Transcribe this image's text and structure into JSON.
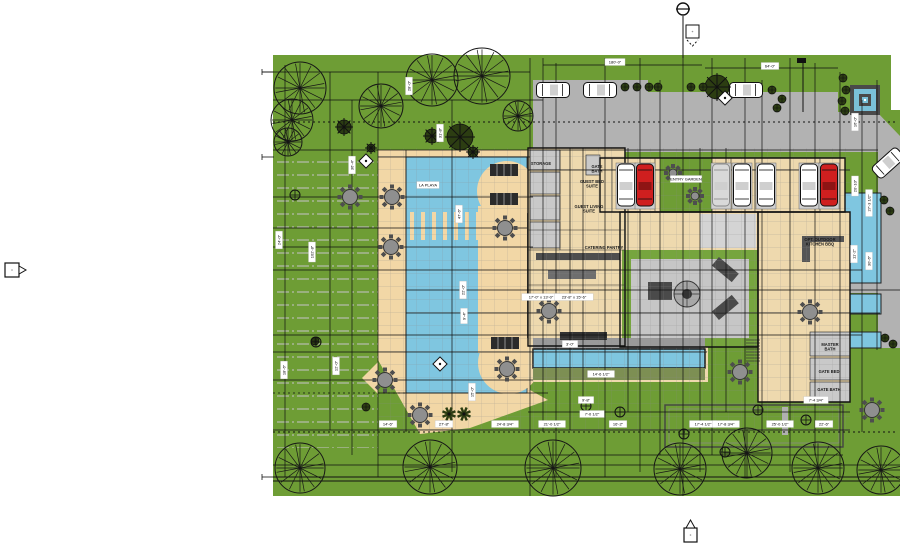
{
  "meta": {
    "drawing_type": "architectural site plan",
    "pool_label": "LA PLAYA"
  },
  "colors": {
    "lawn": "#6e9d35",
    "lawn_stripe": "#a9b698",
    "deck": "#f2d7a6",
    "pool": "#7fc6e0",
    "drive": "#b2b2b2",
    "floor": "#eed9ae",
    "room_gray": "#c9c9c9",
    "court_gray": "#c6c6c6",
    "court_green": "#76a53e",
    "planter_olive": "#7d8f53",
    "dark_furniture": "#3c3c3c",
    "car_red": "#cf1f1f",
    "car_white": "#ffffff",
    "car_ghost": "#d9d9d9",
    "fountain_frame": "#4a4a4a",
    "tree_dark": "#2c3d12"
  },
  "grid": {
    "verticals": [
      [
        285,
        65,
        477
      ],
      [
        330,
        72,
        430
      ],
      [
        352,
        100,
        455
      ],
      [
        378,
        72,
        477
      ],
      [
        406,
        150,
        432
      ],
      [
        452,
        100,
        472
      ],
      [
        530,
        58,
        496
      ],
      [
        543,
        58,
        432
      ],
      [
        556,
        63,
        477
      ],
      [
        570,
        148,
        430
      ],
      [
        583,
        148,
        402
      ],
      [
        605,
        58,
        477
      ],
      [
        628,
        148,
        412
      ],
      [
        640,
        58,
        472
      ],
      [
        660,
        80,
        455
      ],
      [
        683,
        16,
        496
      ],
      [
        700,
        148,
        472
      ],
      [
        712,
        58,
        455
      ],
      [
        726,
        148,
        412
      ],
      [
        745,
        58,
        477
      ],
      [
        762,
        80,
        432
      ],
      [
        790,
        58,
        472
      ],
      [
        815,
        63,
        455
      ],
      [
        840,
        72,
        477
      ],
      [
        862,
        100,
        432
      ],
      [
        877,
        80,
        350
      ]
    ],
    "horizontals": [
      [
        72,
        262,
        530
      ],
      [
        100,
        273,
        543
      ],
      [
        150,
        273,
        878
      ],
      [
        157,
        378,
        530
      ],
      [
        170,
        528,
        850
      ],
      [
        197,
        273,
        533
      ],
      [
        212,
        600,
        850
      ],
      [
        228,
        273,
        527
      ],
      [
        247,
        273,
        533
      ],
      [
        270,
        273,
        862
      ],
      [
        290,
        406,
        900
      ],
      [
        313,
        406,
        880
      ],
      [
        335,
        273,
        862
      ],
      [
        352,
        273,
        707
      ],
      [
        380,
        273,
        533
      ],
      [
        393,
        378,
        548
      ],
      [
        412,
        528,
        850
      ],
      [
        430,
        273,
        850
      ],
      [
        455,
        378,
        843
      ],
      [
        465,
        273,
        900
      ],
      [
        65,
        543,
        702
      ],
      [
        68,
        705,
        838
      ]
    ]
  },
  "dimensions": [
    {
      "x": 279,
      "y": 240,
      "rot": -90,
      "text": "24'-0\""
    },
    {
      "x": 284,
      "y": 370,
      "rot": -90,
      "text": "18'-6\""
    },
    {
      "x": 312,
      "y": 252,
      "rot": -90,
      "text": "102'-8\""
    },
    {
      "x": 336,
      "y": 366,
      "rot": -90,
      "text": "12'-0\""
    },
    {
      "x": 352,
      "y": 165,
      "rot": -90,
      "text": "36'-4\""
    },
    {
      "x": 409,
      "y": 86,
      "rot": -90,
      "text": "28'-0\""
    },
    {
      "x": 440,
      "y": 133,
      "rot": -90,
      "text": "31'-8\""
    },
    {
      "x": 459,
      "y": 214,
      "rot": -90,
      "text": "47'-6\""
    },
    {
      "x": 463,
      "y": 290,
      "rot": -90,
      "text": "22'-0\""
    },
    {
      "x": 464,
      "y": 316,
      "rot": -90,
      "text": "9'-4\""
    },
    {
      "x": 472,
      "y": 392,
      "rot": -90,
      "text": "15'-0\""
    },
    {
      "x": 615,
      "y": 62,
      "rot": 0,
      "text": "180'-0\""
    },
    {
      "x": 770,
      "y": 66,
      "rot": 0,
      "text": "64'-0\""
    },
    {
      "x": 855,
      "y": 122,
      "rot": -90,
      "text": "16'-0\""
    },
    {
      "x": 855,
      "y": 186,
      "rot": -90,
      "text": "20'-10\""
    },
    {
      "x": 869,
      "y": 203,
      "rot": -90,
      "text": "27'-3 1/2\""
    },
    {
      "x": 854,
      "y": 254,
      "rot": -90,
      "text": "11'-2\""
    },
    {
      "x": 869,
      "y": 261,
      "rot": -90,
      "text": "30'-6\""
    },
    {
      "x": 388,
      "y": 424,
      "rot": 0,
      "text": "14'-6\""
    },
    {
      "x": 444,
      "y": 424,
      "rot": 0,
      "text": "27'-8\""
    },
    {
      "x": 505,
      "y": 424,
      "rot": 0,
      "text": "24'-8 3/4\""
    },
    {
      "x": 552,
      "y": 424,
      "rot": 0,
      "text": "21'-0 1/2\""
    },
    {
      "x": 618,
      "y": 424,
      "rot": 0,
      "text": "16'-2\""
    },
    {
      "x": 703,
      "y": 424,
      "rot": 0,
      "text": "17'-4 1/2\""
    },
    {
      "x": 726,
      "y": 424,
      "rot": 0,
      "text": "17'-8 3/4\""
    },
    {
      "x": 780,
      "y": 424,
      "rot": 0,
      "text": "25'-0 1/2\""
    },
    {
      "x": 824,
      "y": 424,
      "rot": 0,
      "text": "22'-6\""
    },
    {
      "x": 816,
      "y": 400,
      "rot": 0,
      "text": "7'-4 3/4\""
    },
    {
      "x": 586,
      "y": 400,
      "rot": 0,
      "text": "9'-8\""
    },
    {
      "x": 541,
      "y": 297,
      "rot": 0,
      "text": "17'-0\" x 13'-0\""
    },
    {
      "x": 574,
      "y": 297,
      "rot": 0,
      "text": "23'-8\" x 15'-6\""
    },
    {
      "x": 570,
      "y": 344,
      "rot": 0,
      "text": "3'-0\""
    },
    {
      "x": 601,
      "y": 374,
      "rot": 0,
      "text": "14'-6 1/2\""
    },
    {
      "x": 592,
      "y": 414,
      "rot": 0,
      "text": "7'-0 1/2\""
    },
    {
      "x": 428,
      "y": 185,
      "rot": 0,
      "text": "LA PLAYA"
    },
    {
      "x": 686,
      "y": 179,
      "rot": 0,
      "text": "ENTRY GARDEN"
    }
  ],
  "rooms": [
    {
      "x": 541,
      "y": 165,
      "text": "STORAGE"
    },
    {
      "x": 597,
      "y": 168,
      "text": "GATE\nBATH"
    },
    {
      "x": 592,
      "y": 183,
      "text": "GUEST BED\nSUITE"
    },
    {
      "x": 589,
      "y": 208,
      "text": "GUEST LIVING\nSUITE"
    },
    {
      "x": 604,
      "y": 249,
      "text": "CATERING PANTRY"
    },
    {
      "x": 820,
      "y": 241,
      "text": "OPT. OUTDOOR\nKITCHEN BBQ"
    },
    {
      "x": 830,
      "y": 346,
      "text": "MASTER\nBATH"
    },
    {
      "x": 829,
      "y": 373,
      "text": "GATE BED"
    },
    {
      "x": 829,
      "y": 391,
      "text": "GATE BATH"
    }
  ],
  "trees_wire": [
    [
      300,
      88,
      26
    ],
    [
      292,
      120,
      21
    ],
    [
      288,
      142,
      14
    ],
    [
      381,
      106,
      22
    ],
    [
      432,
      80,
      26
    ],
    [
      482,
      76,
      28
    ],
    [
      518,
      116,
      15
    ],
    [
      300,
      468,
      25
    ],
    [
      430,
      467,
      27
    ],
    [
      553,
      468,
      28
    ],
    [
      680,
      469,
      26
    ],
    [
      747,
      453,
      25
    ],
    [
      818,
      468,
      26
    ],
    [
      881,
      470,
      24
    ]
  ],
  "trees_leafy": [
    [
      460,
      137,
      13
    ],
    [
      717,
      87,
      12
    ],
    [
      432,
      136,
      7
    ],
    [
      344,
      127,
      7
    ],
    [
      473,
      152,
      5
    ],
    [
      371,
      148,
      4
    ]
  ],
  "shrubs": [
    [
      625,
      87
    ],
    [
      637,
      87
    ],
    [
      649,
      87
    ],
    [
      658,
      87
    ],
    [
      691,
      87
    ],
    [
      703,
      87
    ],
    [
      772,
      90
    ],
    [
      782,
      99
    ],
    [
      777,
      108
    ],
    [
      843,
      78
    ],
    [
      846,
      90
    ],
    [
      842,
      101
    ],
    [
      845,
      111
    ],
    [
      884,
      200
    ],
    [
      890,
      211
    ],
    [
      885,
      338
    ],
    [
      893,
      344
    ],
    [
      366,
      407
    ],
    [
      315,
      341
    ]
  ],
  "palms": [
    [
      449,
      414
    ],
    [
      464,
      414
    ]
  ],
  "tables": [
    [
      350,
      197
    ],
    [
      392,
      197
    ],
    [
      391,
      247
    ],
    [
      385,
      380
    ],
    [
      420,
      415
    ],
    [
      549,
      311
    ],
    [
      810,
      312
    ],
    [
      872,
      410
    ],
    [
      507,
      369
    ],
    [
      505,
      228
    ],
    [
      740,
      372
    ]
  ],
  "mini_tables": [
    [
      673,
      173
    ],
    [
      695,
      196
    ]
  ],
  "loungers": [
    [
      504,
      170
    ],
    [
      504,
      199
    ],
    [
      505,
      343
    ]
  ],
  "cars_street": [
    [
      553,
      90,
      0,
      "white"
    ],
    [
      600,
      90,
      0,
      "white"
    ],
    [
      746,
      90,
      0,
      "white"
    ],
    [
      888,
      163,
      -42,
      "white"
    ]
  ],
  "cars_garage": [
    [
      626,
      "white"
    ],
    [
      645,
      "red"
    ],
    [
      721,
      "ghost"
    ],
    [
      742,
      "white"
    ],
    [
      766,
      "white"
    ],
    [
      809,
      "white"
    ],
    [
      829,
      "red"
    ]
  ],
  "drains": [
    [
      295,
      195
    ],
    [
      316,
      342
    ],
    [
      586,
      406
    ],
    [
      620,
      412
    ],
    [
      758,
      410
    ],
    [
      806,
      420
    ],
    [
      684,
      434
    ],
    [
      725,
      452
    ]
  ],
  "diamonds": [
    [
      366,
      161
    ],
    [
      440,
      364
    ],
    [
      725,
      98
    ]
  ]
}
